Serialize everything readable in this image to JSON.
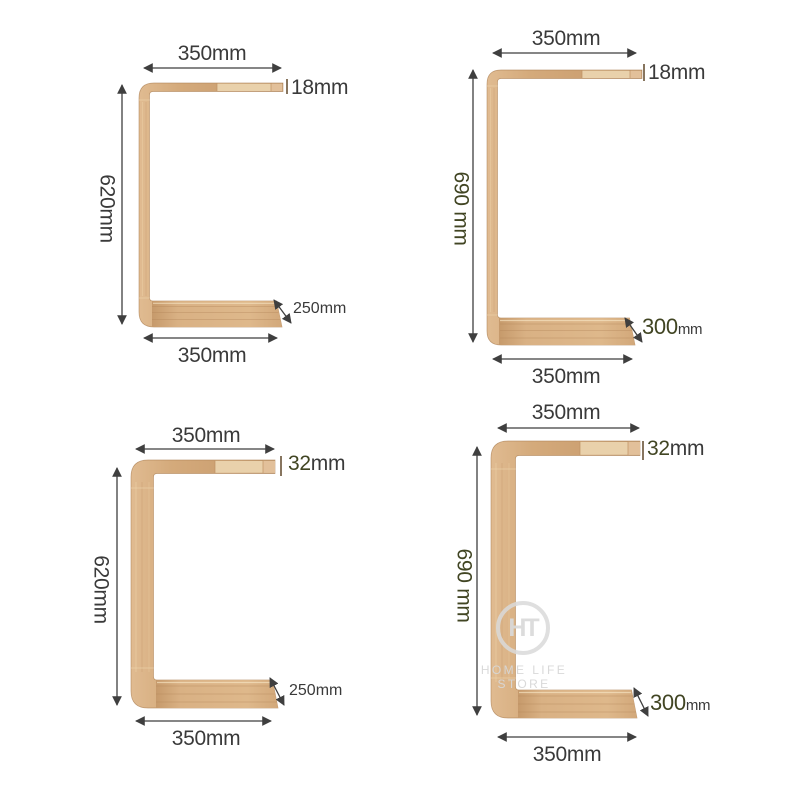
{
  "watermark": {
    "monogram": "HT",
    "store_name": "HOME LIFE STORE"
  },
  "colors": {
    "background": "#ffffff",
    "wood_mid": "#d2a97b",
    "wood_light": "#e9d1ab",
    "wood_dark": "#b2855a",
    "dimension_line": "#3f3f3f",
    "text": "#3a3a3a",
    "text_olive": "#414523",
    "watermark_gray": "#d9d9d9"
  },
  "tables": [
    {
      "position": "top-left",
      "top_width": "350mm",
      "thickness_value": "18",
      "thickness_unit": "mm",
      "height": "620mm",
      "depth_value": "250",
      "depth_unit": "mm",
      "bottom_width": "350mm"
    },
    {
      "position": "top-right",
      "top_width": "350mm",
      "thickness_value": "18",
      "thickness_unit": "mm",
      "height": "690 mm",
      "depth_value": "300",
      "depth_unit": "mm",
      "bottom_width": "350mm"
    },
    {
      "position": "bottom-left",
      "top_width": "350mm",
      "thickness_value": "32",
      "thickness_unit": "mm",
      "height": "620mm",
      "depth_value": "250",
      "depth_unit": "mm",
      "bottom_width": "350mm"
    },
    {
      "position": "bottom-right",
      "top_width": "350mm",
      "thickness_value": "32",
      "thickness_unit": "mm",
      "height": "690 mm",
      "depth_value": "300",
      "depth_unit": "mm",
      "bottom_width": "350mm"
    }
  ]
}
